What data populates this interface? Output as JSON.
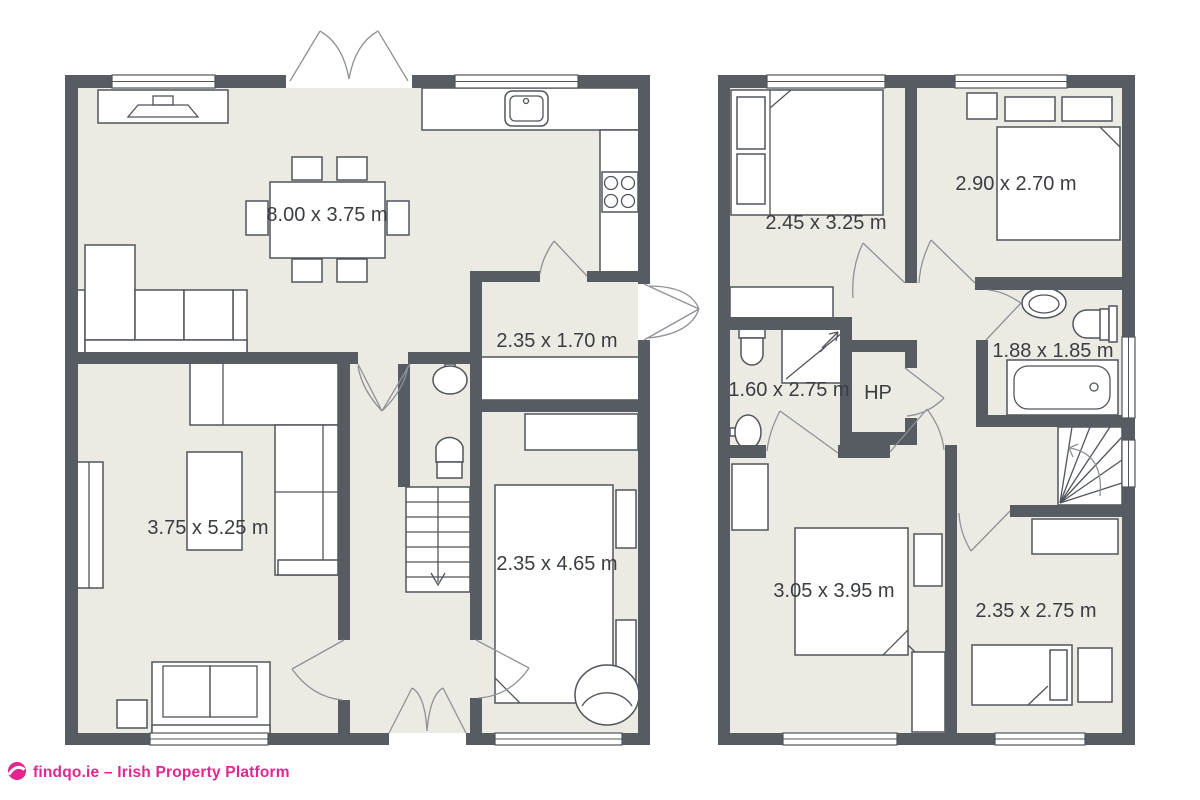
{
  "document": {
    "type": "floor-plan",
    "background": "#ffffff"
  },
  "palette": {
    "wall": "#575C63",
    "floor": "#ECEBE3",
    "furniture_outline": "#50555B",
    "door_arc": "#8E9297",
    "label_text": "#3A3D41",
    "brand_pink": "#E3268E"
  },
  "floors": [
    {
      "id": "ground-floor",
      "rooms": [
        {
          "name": "kitchen-dining-living",
          "dimensions": "8.00 x 3.75 m"
        },
        {
          "name": "entrance-hall",
          "dimensions": "2.35 x 1.70 m"
        },
        {
          "name": "living-room",
          "dimensions": "3.75 x 5.25 m"
        },
        {
          "name": "bedroom-ground",
          "dimensions": "2.35 x 4.65 m"
        }
      ]
    },
    {
      "id": "first-floor",
      "rooms": [
        {
          "name": "bedroom-front",
          "dimensions": "2.45 x 3.25 m"
        },
        {
          "name": "bedroom-rear",
          "dimensions": "2.90 x 2.70 m"
        },
        {
          "name": "shower-room",
          "dimensions": "1.60 x 2.75 m"
        },
        {
          "name": "hot-press",
          "label": "HP"
        },
        {
          "name": "bathroom",
          "dimensions": "1.88 x 1.85 m"
        },
        {
          "name": "bedroom-master",
          "dimensions": "3.05 x 3.95 m"
        },
        {
          "name": "bedroom-single",
          "dimensions": "2.35 x 2.75 m"
        }
      ]
    }
  ],
  "footer": {
    "text": "findqo.ie – Irish Property Platform"
  }
}
